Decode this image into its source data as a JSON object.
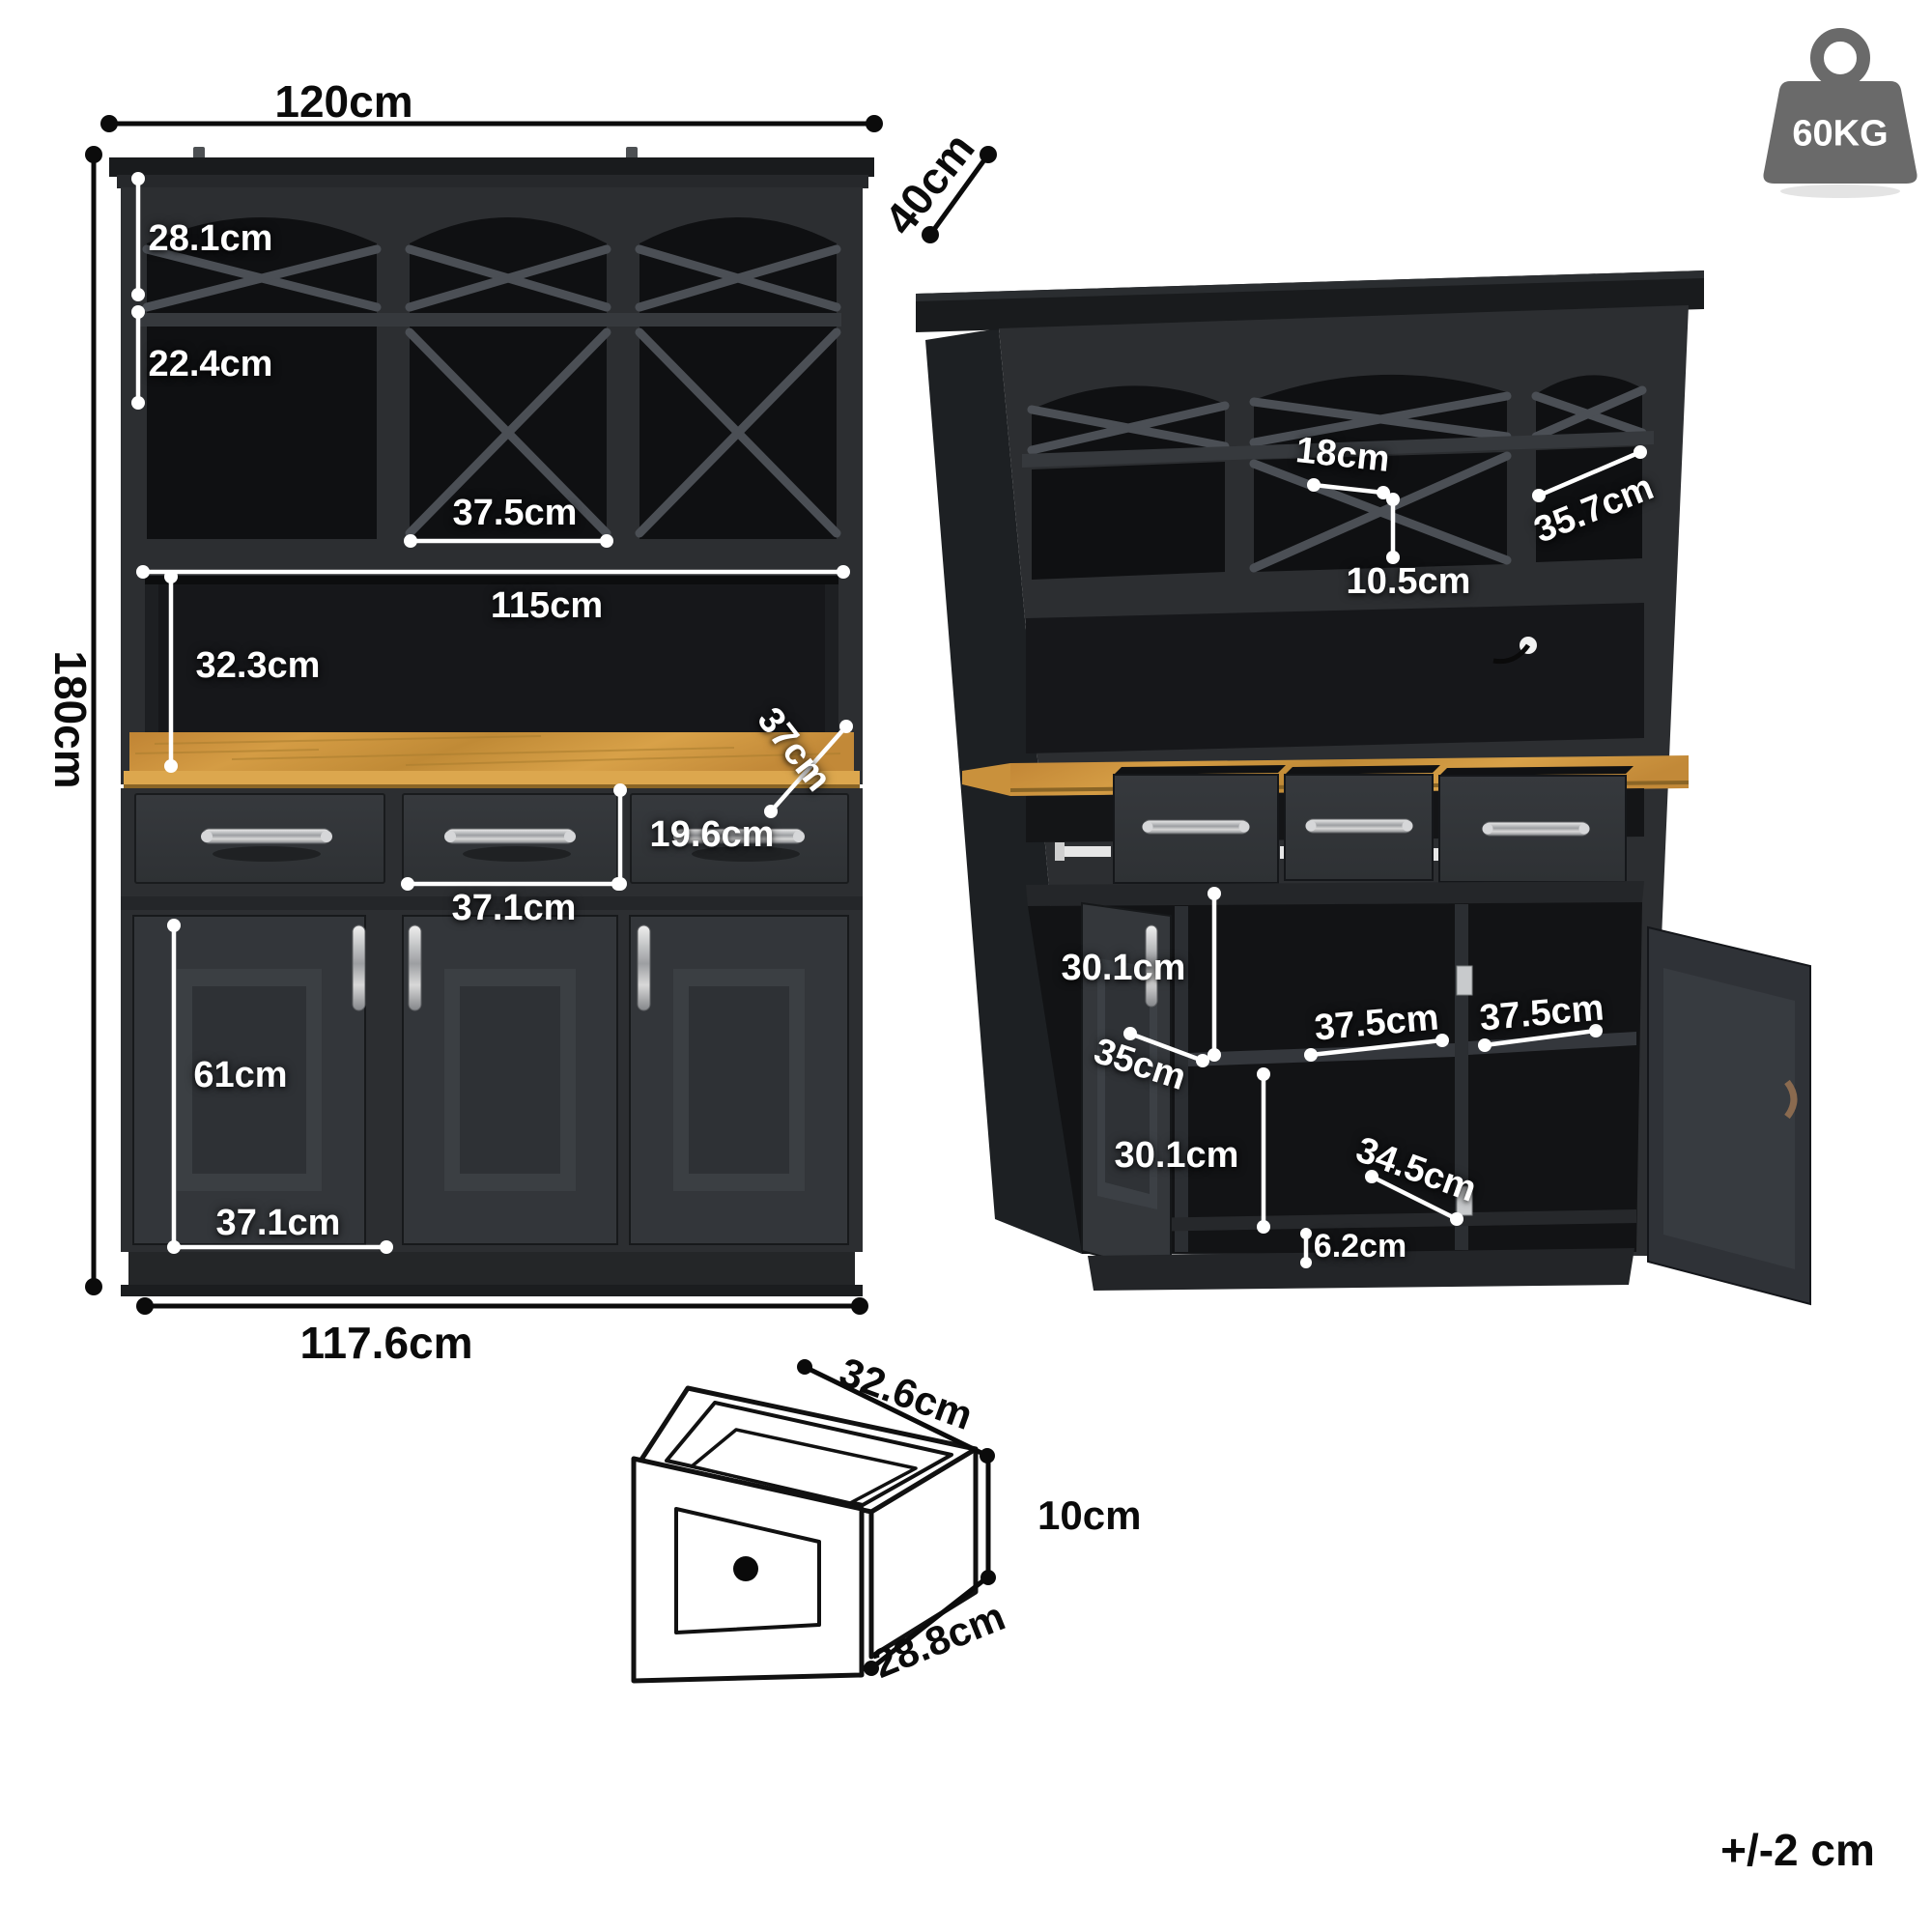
{
  "diagram_title": "cabinet-dimension-diagram",
  "units": "cm",
  "front_view": {
    "top_width": "120cm",
    "height": "180cm",
    "wine_rack_height": "28.1cm",
    "cubby_height": "22.4cm",
    "middle_cubby_width": "37.5cm",
    "hutch_opening_width": "115cm",
    "hutch_opening_height": "32.3cm",
    "countertop_depth": "37cm",
    "drawer_front_height": "19.6cm",
    "drawer_front_width": "37.1cm",
    "door_height": "61cm",
    "door_width": "37.1cm",
    "base_width": "117.6cm"
  },
  "side_view": {
    "depth": "40cm",
    "wine_slot_width": "18cm",
    "wine_slot_height": "10.5cm",
    "upper_cubby_depth": "35.7cm",
    "upper_opening_height": "30.1cm",
    "interior_depth": "35cm",
    "left_shelf_width": "37.5cm",
    "right_shelf_width": "37.5cm",
    "lower_opening_height": "30.1cm",
    "shelf_depth": "34.5cm",
    "plinth_height": "6.2cm"
  },
  "drawer_detail": {
    "width": "32.6cm",
    "height": "10cm",
    "depth": "28.8cm"
  },
  "weight_badge": {
    "label": "60KG"
  },
  "tolerance_note": "+/-2 cm",
  "colors": {
    "cabinet_body": "#2c2e31",
    "cabinet_interior": "#101113",
    "wood_counter": "#c9913c",
    "dimension_white": "#ffffff",
    "dimension_black": "#0b0b0b",
    "badge_gray": "#6a6a6a"
  }
}
